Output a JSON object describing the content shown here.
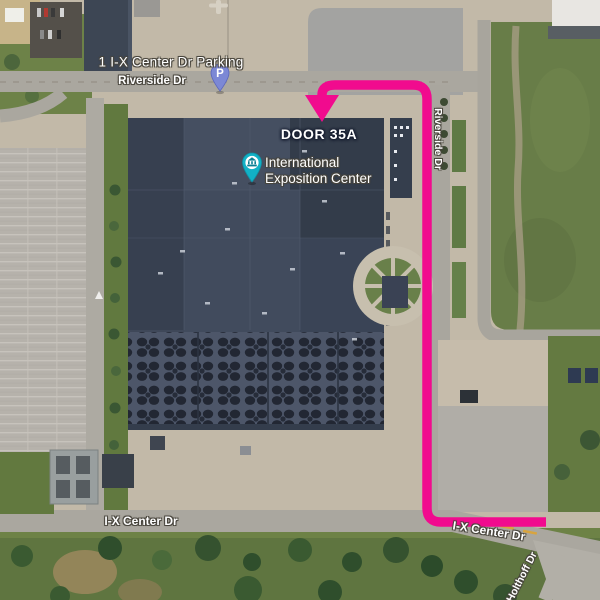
{
  "labels": {
    "parking_place": "1 I-X Center Dr Parking",
    "riverside_dr_top": "Riverside Dr",
    "riverside_dr_east": "Riverside Dr",
    "door_callout": "DOOR 35A",
    "venue_name": "International\nExposition Center",
    "ix_center_dr_west": "I-X Center Dr",
    "ix_center_dr_east": "I-X Center Dr",
    "holthoff_dr": "Holthoff Dr"
  },
  "markers": {
    "parking_pin": {
      "glyph": "P",
      "color": "#7c88d5",
      "border": "#5a66bd"
    },
    "venue_pin": {
      "color": "#12b1c6",
      "border": "#0d93a6"
    }
  },
  "route": {
    "color": "#f10b8e"
  }
}
